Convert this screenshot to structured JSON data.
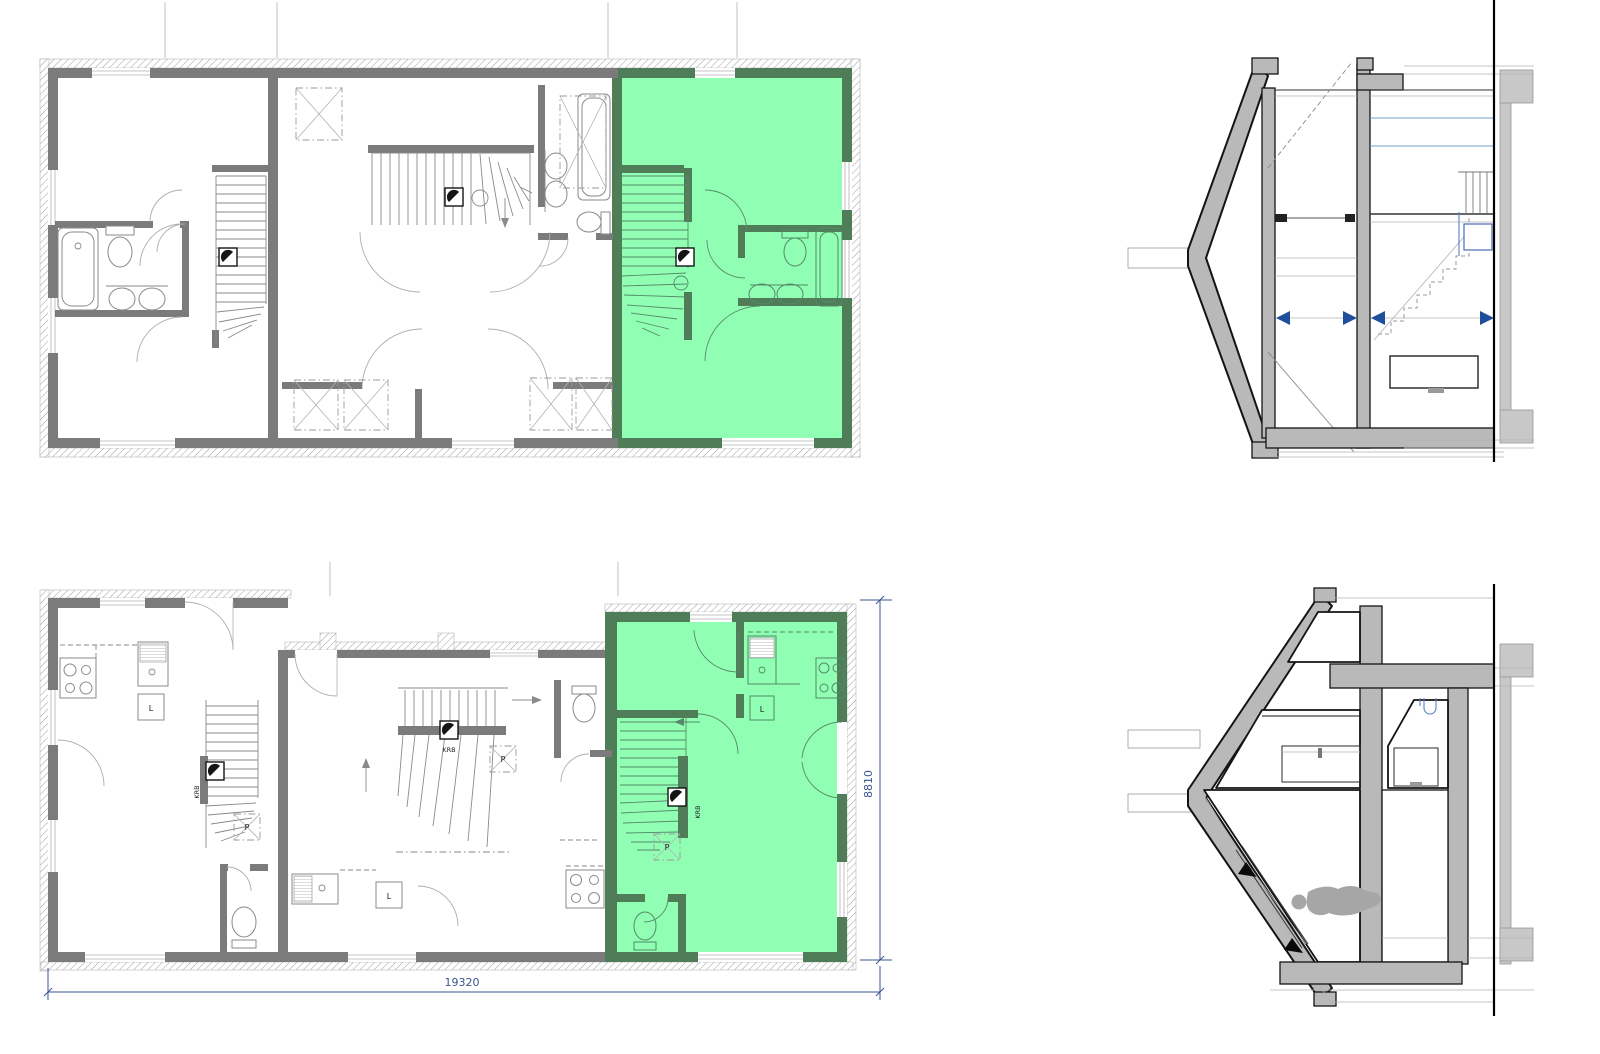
{
  "colors": {
    "highlight_fill": "#90ffb4",
    "highlight_wall": "#4e7d58",
    "highlight_line": "#55896a",
    "wall_gray": "#7b7b7b",
    "section_fill": "#b9b9b9",
    "section_side": "#c8c8c8",
    "dim_blue": "#3a5390",
    "marker_blue": "#1f4e9c",
    "plumb_blue": "#5b82c4",
    "person_gray": "#a6a6a6"
  },
  "labels": {
    "chimney": "KRB",
    "pantry": "P",
    "larder": "L"
  },
  "dimensions": {
    "total_width": "19320",
    "unit_depth": "8810"
  }
}
